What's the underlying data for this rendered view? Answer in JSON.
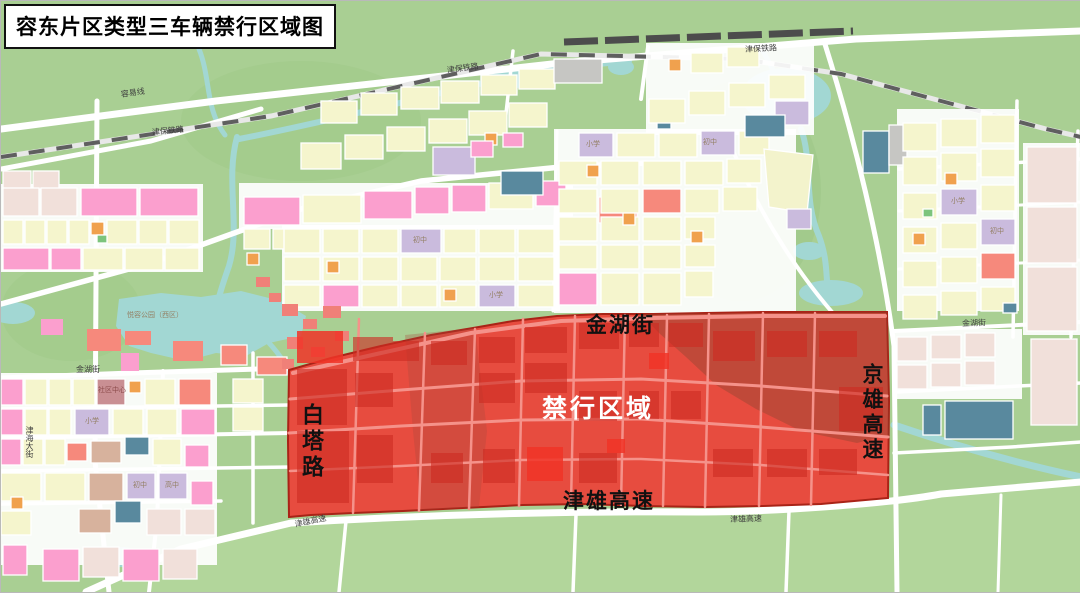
{
  "title": "容东片区类型三车辆禁行区域图",
  "zone": {
    "name": "禁行区域",
    "top_street": "金湖街",
    "left_road": "白塔路",
    "right_expressway": "京雄高速",
    "bottom_expressway": "津雄高速"
  },
  "small_labels": [
    {
      "text": "容易线"
    },
    {
      "text": "津保铁路"
    },
    {
      "text": "津保铁路"
    },
    {
      "text": "津保铁路"
    },
    {
      "text": "金湖街"
    },
    {
      "text": "金湖街"
    },
    {
      "text": "津海大街"
    },
    {
      "text": "津雄高速"
    },
    {
      "text": "津雄高速"
    },
    {
      "text": "悦容公园（西区）"
    },
    {
      "text": "小学"
    },
    {
      "text": "初中"
    },
    {
      "text": "小学"
    },
    {
      "text": "初中"
    },
    {
      "text": "小学"
    },
    {
      "text": "初中"
    },
    {
      "text": "初中"
    },
    {
      "text": "高中"
    },
    {
      "text": "小学"
    },
    {
      "text": "社区中心"
    }
  ],
  "colors": {
    "background_green": "#a9cf93",
    "field_green": "#b2d69b",
    "water_blue": "#a2d7d3",
    "road_white": "#ffffff",
    "railway_dark": "#5f5f5f",
    "zone_red": "#e74c3f",
    "zone_block_red": "#cd2b22",
    "zone_park_maroon": "#8a4433",
    "zone_road_pink": "#f5928a",
    "block_yellow": "#f5f5cd",
    "block_pink": "#fb9fce",
    "block_salmon": "#f6897c",
    "block_purple": "#cabbdd",
    "block_orange": "#f0a14e",
    "block_teal": "#59899e",
    "block_beige": "#f1e0da",
    "title_border": "#111111"
  }
}
